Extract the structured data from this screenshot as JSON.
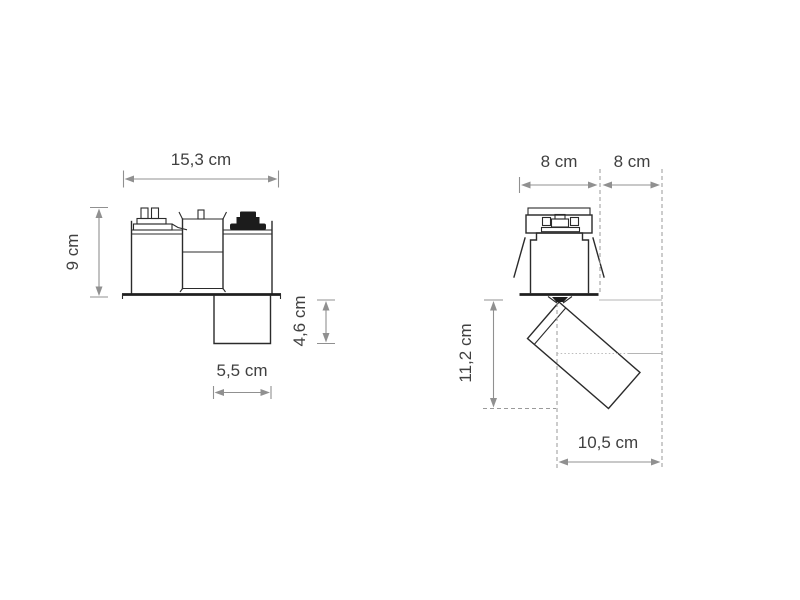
{
  "drawing": {
    "front_view": {
      "overall_width": "15,3 cm",
      "overall_height": "9 cm",
      "trim_width": "5,5 cm",
      "trim_depth": "4,6 cm"
    },
    "side_view": {
      "housing_width": "8 cm",
      "side_offset": "8 cm",
      "head_drop": "11,2 cm",
      "head_reach": "10,5 cm"
    }
  }
}
